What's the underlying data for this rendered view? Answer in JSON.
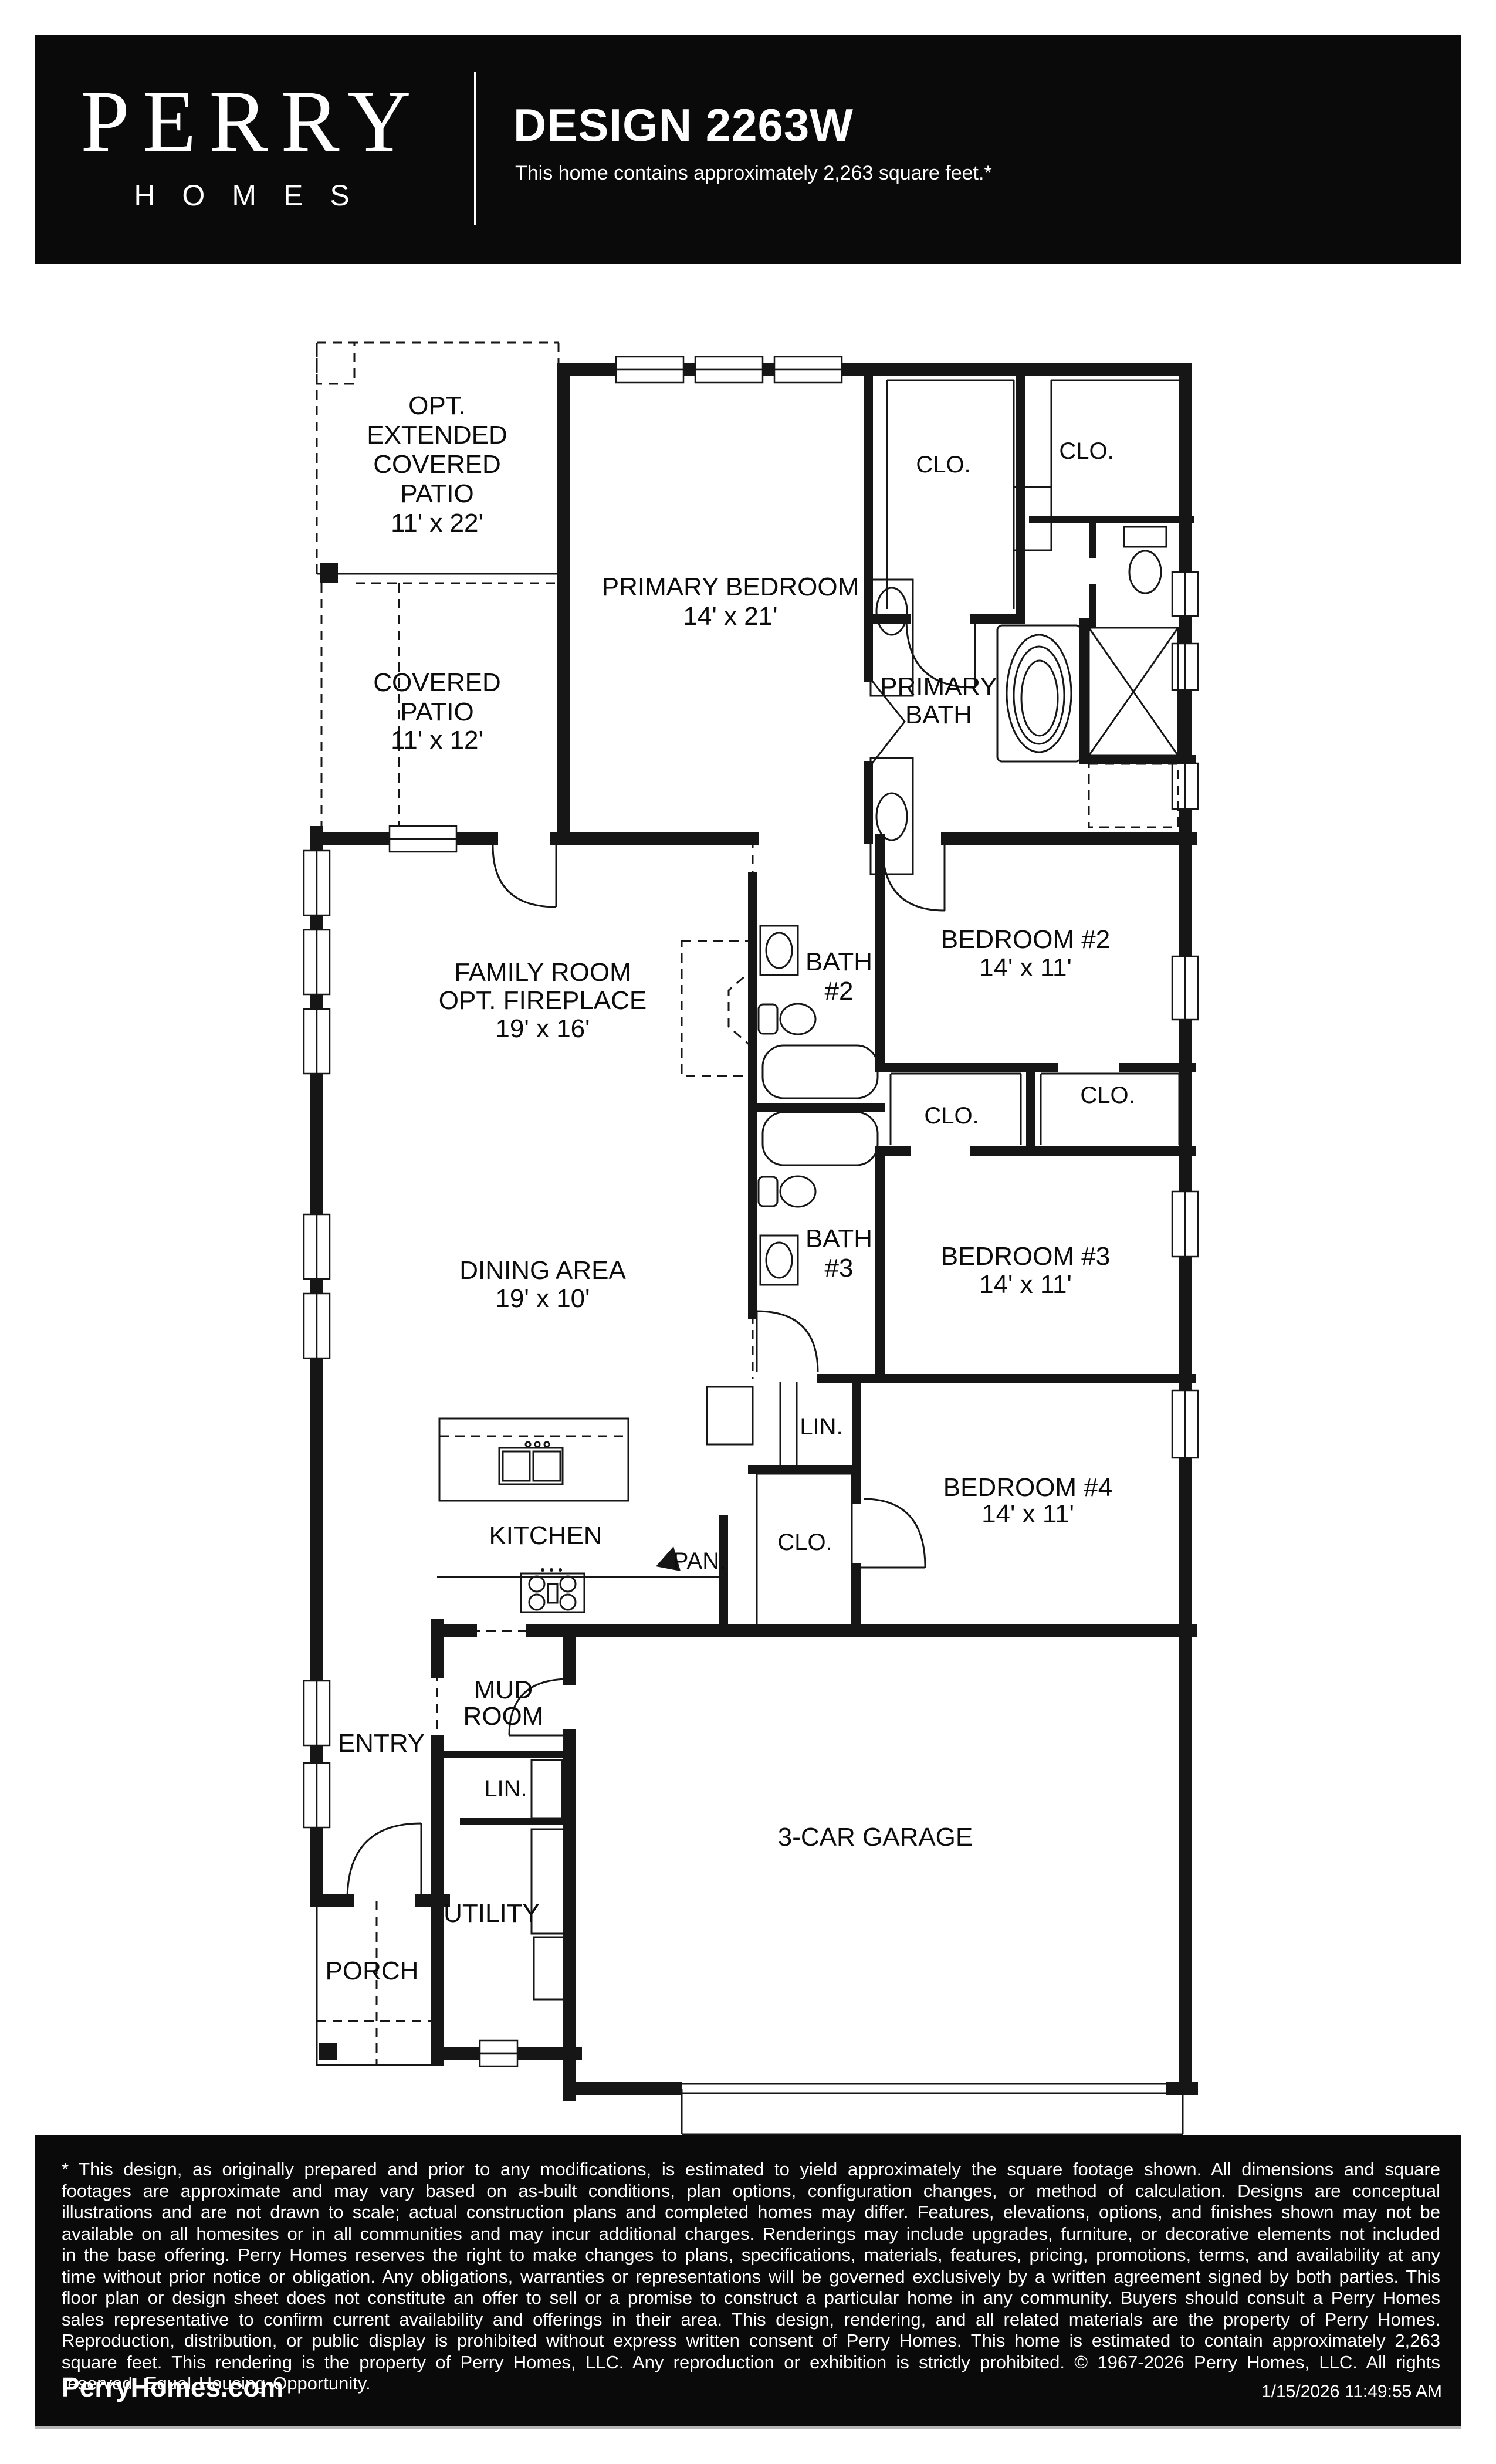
{
  "header": {
    "brand_line1": "PERRY",
    "brand_line2": "HOMES",
    "title": "DESIGN 2263W",
    "subtitle": "This home contains approximately 2,263 square feet.*"
  },
  "plan": {
    "opt_patio": {
      "l1": "OPT.",
      "l2": "EXTENDED",
      "l3": "COVERED",
      "l4": "PATIO",
      "dims": "11' x 22'"
    },
    "covered_patio": {
      "l1": "COVERED",
      "l2": "PATIO",
      "dims": "11' x 12'"
    },
    "primary_bedroom": {
      "label": "PRIMARY BEDROOM",
      "dims": "14' x 21'"
    },
    "clo_primary_1": "CLO.",
    "clo_primary_2": "CLO.",
    "primary_bath": {
      "l1": "PRIMARY",
      "l2": "BATH"
    },
    "family_room": {
      "l1": "FAMILY ROOM",
      "l2": "OPT. FIREPLACE",
      "dims": "19' x 16'"
    },
    "bath2": {
      "l1": "BATH",
      "l2": "#2"
    },
    "bedroom2": {
      "label": "BEDROOM #2",
      "dims": "14' x 11'"
    },
    "clo_bed3": "CLO.",
    "clo_bed2": "CLO.",
    "bath3": {
      "l1": "BATH",
      "l2": "#3"
    },
    "bedroom3": {
      "label": "BEDROOM #3",
      "dims": "14' x 11'"
    },
    "dining": {
      "label": "DINING AREA",
      "dims": "19' x 10'"
    },
    "lin_hall": "LIN.",
    "bedroom4": {
      "label": "BEDROOM #4",
      "dims": "14' x 11'"
    },
    "kitchen": "KITCHEN",
    "pantry": "PAN.",
    "clo_bed4": "CLO.",
    "mud_room": {
      "l1": "MUD",
      "l2": "ROOM"
    },
    "entry": "ENTRY",
    "lin_utility": "LIN.",
    "utility": "UTILITY",
    "porch": "PORCH",
    "garage": "3-CAR GARAGE"
  },
  "footer": {
    "disclaimer": "* This design, as originally prepared and prior to any modifications, is estimated to  yield approximately the  square footage  shown.  All dimensions and  square footages are approximate and  may vary based  on as-built conditions,  plan options,  configuration changes,  or method of  calculation.  Designs are  conceptual  illustrations and  are not drawn to scale; actual construction plans and completed homes may differ.  Features, elevations,  options,  and finishes shown may not be available on all homesites or in all communities and may incur additional charges.  Renderings may include upgrades, furniture, or decorative elements not included in the base offering. Perry Homes reserves the right to make  changes  to  plans,  specifications,  materials,  features,  pricing,  promotions,  terms,  and  availability  at any time without  prior  notice  or  obligation.  Any obligations, warranties or representations will be governed exclusively by a written agreement signed  by both parties.  This floor plan or  design sheet  does not constitute an offer to sell or a  promise to  construct a  particular  home in any  community.  Buyers  should consult a  Perry Homes sales  representative to confirm  current availability and offerings in their area.  This design,  rendering,  and all related  materials are  the property of Perry Homes.  Reproduction,  distribution,  or public display is prohibited without express written  consent of  Perry Homes. This  home  is  estimated to  contain approximately 2,263 square feet.  This rendering is  the property of Perry Homes, LLC.  Any reproduction or exhibition is strictly prohibited. © 1967-2026 Perry Homes, LLC.  All rights reserved.  Equal Housing Opportunity.",
    "website": "PerryHomes.com",
    "timestamp": "1/15/2026 11:49:55 AM"
  },
  "colors": {
    "bar_background": "#0a0a0a",
    "bar_text": "#ffffff",
    "wall_ink": "#161616"
  }
}
